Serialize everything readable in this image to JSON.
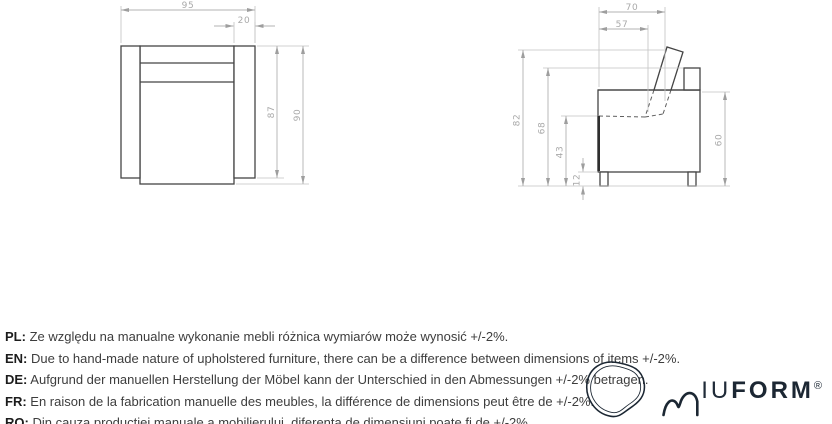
{
  "front_view": {
    "dims": {
      "total_width": "95",
      "armrest_width": "20",
      "body_height": "87",
      "total_height": "90"
    }
  },
  "side_view": {
    "dims": {
      "total_depth": "70",
      "seat_depth": "57",
      "overall_height": "82",
      "backrest_height": "68",
      "seat_height": "43",
      "leg_height": "12",
      "body_height": "60"
    }
  },
  "notes": [
    {
      "label": "PL:",
      "text": "Ze względu na manualne wykonanie mebli różnica wymiarów może wynosić +/-2%."
    },
    {
      "label": "EN:",
      "text": "Due to hand-made nature of upholstered furniture, there can be a difference between dimensions of items +/-2%."
    },
    {
      "label": "DE:",
      "text": "Aufgrund der manuellen Herstellung der Möbel kann der Unterschied in den Abmessungen +/-2% betragen."
    },
    {
      "label": "FR:",
      "text": "En raison de la fabrication manuelle des meubles, la différence de dimensions peut être de +/-2%."
    },
    {
      "label": "RO:",
      "text": "Din cauza producției manuale a mobilierului, diferența de dimensiuni poate fi de +/-2%."
    }
  ],
  "logo": {
    "brand": "MIUFORM",
    "wordmark_light": "IU",
    "wordmark_bold": "FORM",
    "registered_mark": "®"
  },
  "colors": {
    "outline": "#454545",
    "dimension_line": "#b3b3b3",
    "dimension_text": "#a9a9a9",
    "note_text": "#3d3d3d",
    "logo": "#1c2733",
    "background": "#ffffff"
  }
}
